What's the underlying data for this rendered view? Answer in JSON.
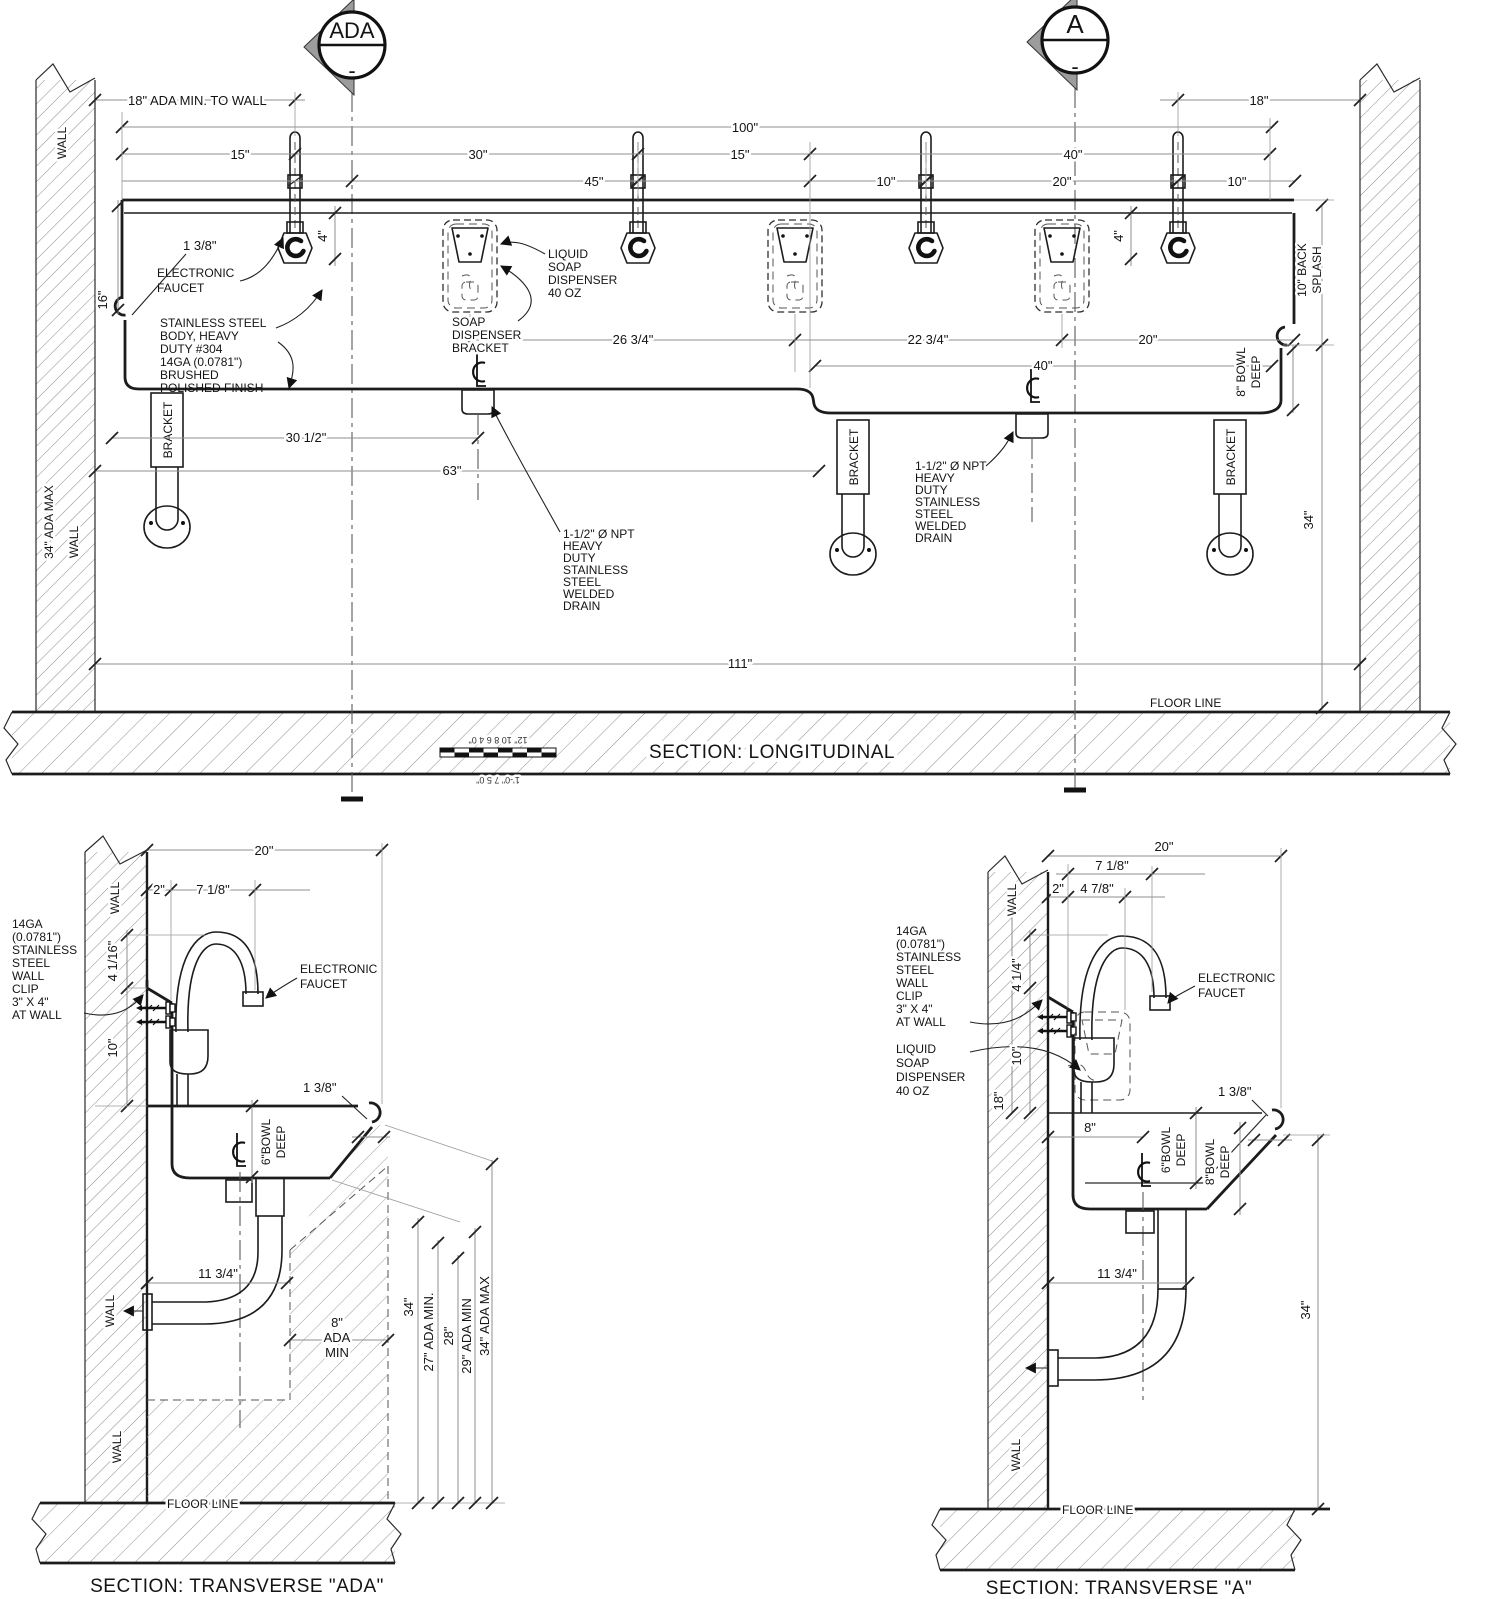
{
  "markers": {
    "ada": {
      "label": "ADA",
      "sub": "-"
    },
    "a": {
      "label": "A",
      "sub": "-"
    }
  },
  "longitudinal": {
    "title": "SECTION: LONGITUDINAL",
    "floor_line": "FLOOR LINE",
    "wall_top": "WALL",
    "wall_bottom": "WALL",
    "ada_max_34": "34\" ADA MAX",
    "dims": {
      "ada_wall": "18\" ADA MIN. TO WALL",
      "d18": "18\"",
      "d100": "100\"",
      "d15a": "15\"",
      "d30": "30\"",
      "d15b": "15\"",
      "d40a": "40\"",
      "d45": "45\"",
      "d10a": "10\"",
      "d20a": "20\"",
      "d10b": "10\"",
      "d4a": "4\"",
      "d4b": "4\"",
      "d16": "16\"",
      "d138": "1 3/8\"",
      "d2634": "26 3/4\"",
      "d2234": "22 3/4\"",
      "d20b": "20\"",
      "d40b": "40\"",
      "d3012": "30 1/2\"",
      "d63": "63\"",
      "d111": "111\"",
      "d34": "34\""
    },
    "labels": {
      "electronic_faucet": [
        "ELECTRONIC",
        "FAUCET"
      ],
      "body": [
        "STAINLESS STEEL",
        "BODY, HEAVY",
        "DUTY #304",
        "14GA (0.0781\")",
        "BRUSHED",
        "POLISHED FINISH"
      ],
      "soap": [
        "LIQUID",
        "SOAP",
        "DISPENSER",
        "40 OZ"
      ],
      "soap_bracket": [
        "SOAP",
        "DISPENSER",
        "BRACKET"
      ],
      "drain": [
        "1-1/2\" Ø NPT",
        "HEAVY",
        "DUTY",
        "STAINLESS",
        "STEEL",
        "WELDED",
        "DRAIN"
      ],
      "bracket": "BRACKET",
      "back_splash": [
        "10\" BACK",
        "SPLASH"
      ],
      "bowl_deep": [
        "8\" BOWL",
        "DEEP"
      ]
    },
    "scale": {
      "top": "12\" 10 8 6 4 0\"",
      "bottom": "1'-0\" 7 5 0\""
    }
  },
  "transverse_ada": {
    "title": "SECTION: TRANSVERSE \"ADA\"",
    "floor_line": "FLOOR LINE",
    "wall1": "WALL",
    "wall2": "WALL",
    "wall3": "WALL",
    "dims": {
      "d20": "20\"",
      "d2": "2\"",
      "d718": "7 1/8\"",
      "d4116": "4 1/16\"",
      "d10": "10\"",
      "d138": "1 3/8\"",
      "d1134": "11 3/4\"",
      "ada8": [
        "8\"",
        "ADA",
        "MIN"
      ],
      "v34": "34\"",
      "v27": "27\" ADA MIN.",
      "v28": "28\"",
      "v29": "29\" ADA MIN",
      "v34max": "34\" ADA MAX"
    },
    "labels": {
      "wall_clip": [
        "14GA",
        "(0.0781\")",
        "STAINLESS",
        "STEEL",
        "WALL",
        "CLIP",
        "3\" X 4\"",
        "AT WALL"
      ],
      "electronic_faucet": [
        "ELECTRONIC",
        "FAUCET"
      ],
      "bowl6": [
        "6\"BOWL",
        "DEEP"
      ]
    }
  },
  "transverse_a": {
    "title": "SECTION: TRANSVERSE \"A\"",
    "floor_line": "FLOOR LINE",
    "wall1": "WALL",
    "wall2": "WALL",
    "dims": {
      "d20": "20\"",
      "d718": "7 1/8\"",
      "d2": "2\"",
      "d478": "4 7/8\"",
      "d414": "4 1/4\"",
      "d10": "10\"",
      "d18": "18\"",
      "d8": "8\"",
      "d138": "1 3/8\"",
      "d1134": "11 3/4\"",
      "d34": "34\""
    },
    "labels": {
      "wall_clip": [
        "14GA",
        "(0.0781\")",
        "STAINLESS",
        "STEEL",
        "WALL",
        "CLIP",
        "3\" X 4\"",
        "AT WALL"
      ],
      "soap": [
        "LIQUID",
        "SOAP",
        "DISPENSER",
        "40 OZ"
      ],
      "electronic_faucet": [
        "ELECTRONIC",
        "FAUCET"
      ],
      "bowl6": [
        "6\"BOWL",
        "DEEP"
      ],
      "bowl8": [
        "8\"BOWL",
        "DEEP"
      ]
    }
  }
}
